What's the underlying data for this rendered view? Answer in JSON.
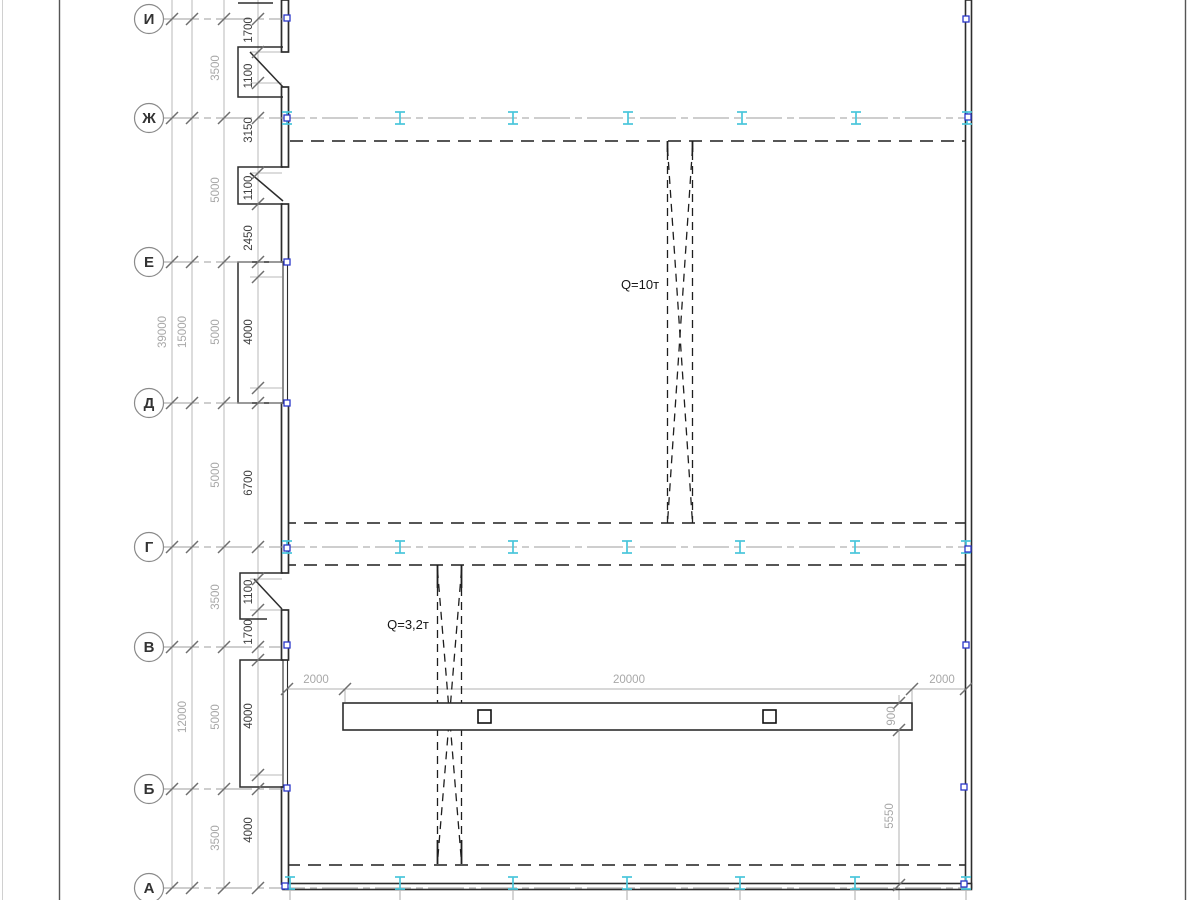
{
  "page": {
    "background": "#ffffff"
  },
  "colors": {
    "axis_line": "#9e9e9e",
    "chain_line": "#b9b9b9",
    "dim_text_light": "#a8a8a8",
    "dim_text_dark": "#3f3f3f",
    "wall": "#2d2d2d",
    "dash": "#1e1e1e",
    "column_cyan": "#49c6db",
    "marker_blue": "#2a35c8",
    "tick": "#6f6f6f",
    "bubble_stroke": "#8a8a8a",
    "bubble_text": "#333333",
    "frame": "#555555",
    "frame_light": "#d0d0d0"
  },
  "axes": [
    {
      "label": "И",
      "y": 19,
      "x_end": 283
    },
    {
      "label": "Ж",
      "y": 118,
      "x_end": 966
    },
    {
      "label": "Е",
      "y": 262,
      "x_end": 283
    },
    {
      "label": "Д",
      "y": 403,
      "x_end": 283
    },
    {
      "label": "Г",
      "y": 547,
      "x_end": 966
    },
    {
      "label": "В",
      "y": 647,
      "x_end": 281
    },
    {
      "label": "Б",
      "y": 789,
      "x_end": 283
    },
    {
      "label": "А",
      "y": 888,
      "x_end": 966
    }
  ],
  "dim_labels_vertical": [
    {
      "text": "39000",
      "x": 166,
      "y": 332,
      "tone": "light"
    },
    {
      "text": "15000",
      "x": 186,
      "y": 332,
      "tone": "light"
    },
    {
      "text": "12000",
      "x": 186,
      "y": 717,
      "tone": "light"
    },
    {
      "text": "3500",
      "x": 219,
      "y": 68,
      "tone": "light"
    },
    {
      "text": "5000",
      "x": 219,
      "y": 190,
      "tone": "light"
    },
    {
      "text": "5000",
      "x": 219,
      "y": 332,
      "tone": "light"
    },
    {
      "text": "5000",
      "x": 219,
      "y": 475,
      "tone": "light"
    },
    {
      "text": "3500",
      "x": 219,
      "y": 597,
      "tone": "light"
    },
    {
      "text": "5000",
      "x": 219,
      "y": 717,
      "tone": "light"
    },
    {
      "text": "3500",
      "x": 219,
      "y": 838,
      "tone": "light"
    },
    {
      "text": "1700",
      "x": 252,
      "y": 30,
      "tone": "dark"
    },
    {
      "text": "1100",
      "x": 252,
      "y": 76,
      "tone": "dark"
    },
    {
      "text": "3150",
      "x": 252,
      "y": 130,
      "tone": "dark"
    },
    {
      "text": "1100",
      "x": 252,
      "y": 188,
      "tone": "dark"
    },
    {
      "text": "2450",
      "x": 252,
      "y": 238,
      "tone": "dark"
    },
    {
      "text": "4000",
      "x": 252,
      "y": 332,
      "tone": "dark"
    },
    {
      "text": "6700",
      "x": 252,
      "y": 483,
      "tone": "dark"
    },
    {
      "text": "1100",
      "x": 252,
      "y": 592,
      "tone": "dark"
    },
    {
      "text": "1700",
      "x": 252,
      "y": 632,
      "tone": "dark"
    },
    {
      "text": "4000",
      "x": 252,
      "y": 716,
      "tone": "dark"
    },
    {
      "text": "4000",
      "x": 252,
      "y": 830,
      "tone": "dark"
    },
    {
      "text": "900",
      "x": 895,
      "y": 716,
      "tone": "light"
    },
    {
      "text": "5550",
      "x": 893,
      "y": 816,
      "tone": "light"
    }
  ],
  "dim_labels_horizontal": [
    {
      "text": "2000",
      "x": 316,
      "y": 683
    },
    {
      "text": "20000",
      "x": 629,
      "y": 683
    },
    {
      "text": "2000",
      "x": 942,
      "y": 683
    }
  ],
  "crane_labels": [
    {
      "text": "Q=10т",
      "x": 640,
      "y": 289
    },
    {
      "text": "Q=3,2т",
      "x": 408,
      "y": 629
    }
  ],
  "columns_rows": [
    {
      "y": 118,
      "xs": [
        287,
        400,
        513,
        628,
        742,
        856,
        967
      ]
    },
    {
      "y": 547,
      "xs": [
        287,
        400,
        513,
        627,
        740,
        855,
        966
      ]
    },
    {
      "y": 883,
      "xs": [
        290,
        400,
        513,
        627,
        740,
        855,
        966
      ]
    }
  ],
  "node_markers": [
    [
      287,
      18
    ],
    [
      287,
      118
    ],
    [
      287,
      262
    ],
    [
      287,
      403
    ],
    [
      287,
      548
    ],
    [
      287,
      645
    ],
    [
      287,
      788
    ],
    [
      285,
      886
    ],
    [
      966,
      19
    ],
    [
      968,
      117
    ],
    [
      968,
      549
    ],
    [
      966,
      645
    ],
    [
      964,
      787
    ],
    [
      964,
      884
    ]
  ]
}
